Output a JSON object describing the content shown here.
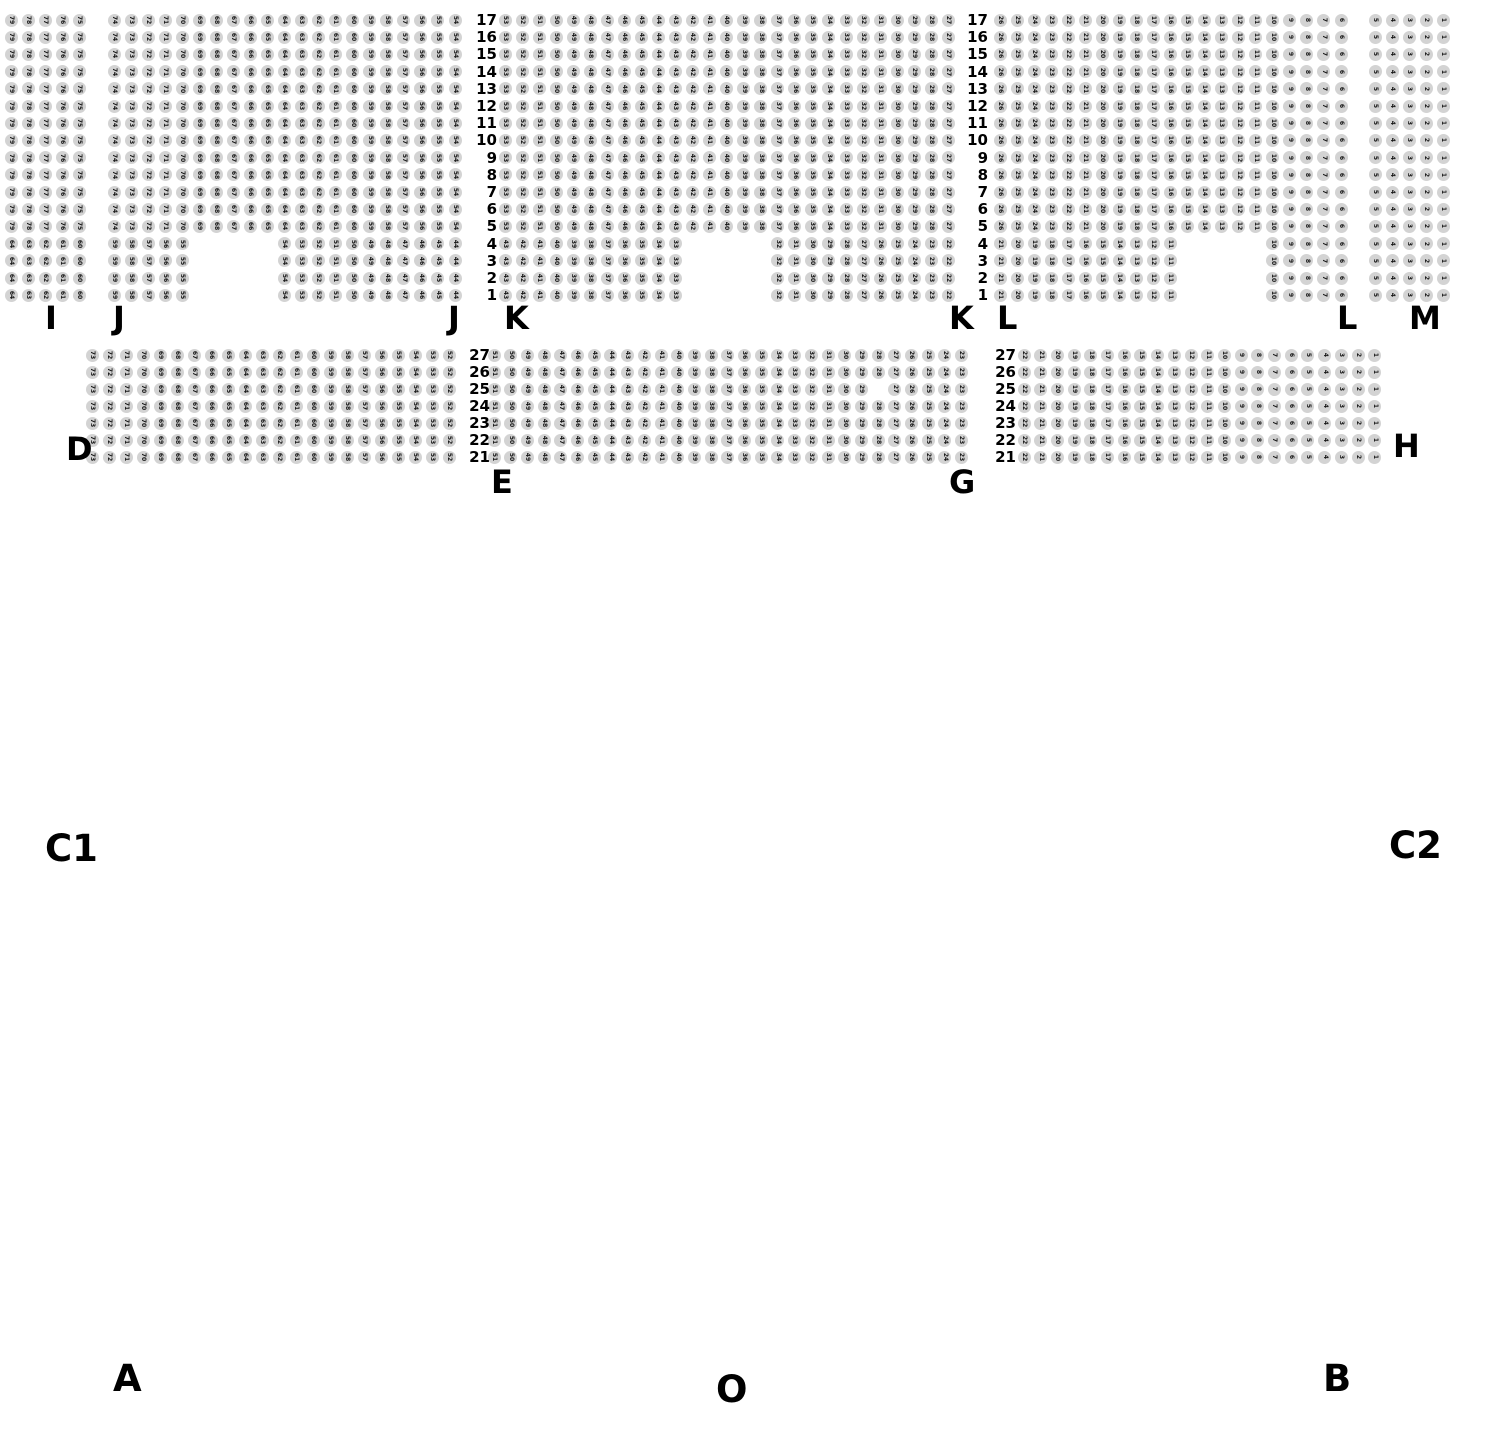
{
  "canvas": {
    "width": 1490,
    "height": 1430,
    "background": "#ffffff"
  },
  "seat_style": {
    "fill": "#d3d3d3",
    "number_color": "#151515",
    "diameter": 13
  },
  "top_block": {
    "y_first_row": 20,
    "row_step": 17.2,
    "rows_from": 17,
    "rows_to": 1,
    "full_rows_until": 5,
    "row_label_cols_x": [
      497,
      988
    ],
    "sections": [
      {
        "name": "I",
        "x0": 11,
        "dx": 17.05,
        "cols": 5,
        "first_seat": 79,
        "short_blocks": [
          {
            "start_col": 1,
            "count": 5,
            "first_seat": 64
          }
        ]
      },
      {
        "name": "J",
        "x0": 114,
        "dx": 17.05,
        "cols": 21,
        "first_seat": 74,
        "short_blocks": [
          {
            "start_col": 1,
            "count": 5,
            "first_seat": 59
          },
          {
            "start_col": 11,
            "count": 11,
            "first_seat": 54
          }
        ]
      },
      {
        "name": "K",
        "x0": 505,
        "dx": 17.05,
        "cols": 27,
        "first_seat": 53,
        "short_blocks": [
          {
            "start_col": 1,
            "count": 11,
            "first_seat": 43
          },
          {
            "start_col": 17,
            "count": 11,
            "first_seat": 32
          }
        ]
      },
      {
        "name": "L",
        "x0": 1000,
        "dx": 17.05,
        "cols": 21,
        "first_seat": 26,
        "short_blocks": [
          {
            "start_col": 1,
            "count": 11,
            "first_seat": 21
          },
          {
            "start_col": 17,
            "count": 5,
            "first_seat": 10
          }
        ]
      },
      {
        "name": "M",
        "x0": 1375,
        "dx": 17.05,
        "cols": 5,
        "first_seat": 5,
        "short_blocks": [
          {
            "start_col": 1,
            "count": 5,
            "first_seat": 5
          }
        ]
      }
    ]
  },
  "middle_block": {
    "y_first_row": 355,
    "row_step": 17,
    "rows_from": 27,
    "rows_to": 21,
    "row_label_cols_x": [
      490,
      1016
    ],
    "sections": [
      {
        "name": "D",
        "x0": 92,
        "dx": 17.0,
        "cols": 22,
        "first_seat": 73,
        "missing": []
      },
      {
        "name": "E-G",
        "x0": 494,
        "dx": 16.7,
        "cols": 29,
        "first_seat": 51,
        "missing": [
          {
            "row": 25,
            "seat": 28
          }
        ]
      },
      {
        "name": "H",
        "x0": 1024,
        "dx": 16.7,
        "cols": 22,
        "first_seat": 22,
        "missing": []
      }
    ]
  },
  "section_labels": [
    {
      "text": "I",
      "x": 45,
      "y": 302,
      "kind": "sec"
    },
    {
      "text": "J",
      "x": 113,
      "y": 302,
      "kind": "sec"
    },
    {
      "text": "J",
      "x": 448,
      "y": 302,
      "kind": "sec"
    },
    {
      "text": "K",
      "x": 504,
      "y": 302,
      "kind": "sec"
    },
    {
      "text": "K",
      "x": 949,
      "y": 302,
      "kind": "sec"
    },
    {
      "text": "L",
      "x": 997,
      "y": 302,
      "kind": "sec"
    },
    {
      "text": "L",
      "x": 1337,
      "y": 302,
      "kind": "sec"
    },
    {
      "text": "M",
      "x": 1409,
      "y": 302,
      "kind": "sec"
    },
    {
      "text": "D",
      "x": 66,
      "y": 433,
      "kind": "sec"
    },
    {
      "text": "E",
      "x": 491,
      "y": 466,
      "kind": "sec"
    },
    {
      "text": "G",
      "x": 949,
      "y": 466,
      "kind": "sec"
    },
    {
      "text": "H",
      "x": 1393,
      "y": 430,
      "kind": "sec"
    },
    {
      "text": "C1",
      "x": 45,
      "y": 830,
      "kind": "zone"
    },
    {
      "text": "C2",
      "x": 1389,
      "y": 827,
      "kind": "zone"
    },
    {
      "text": "A",
      "x": 113,
      "y": 1360,
      "kind": "zone"
    },
    {
      "text": "O",
      "x": 716,
      "y": 1371,
      "kind": "zone"
    },
    {
      "text": "B",
      "x": 1323,
      "y": 1360,
      "kind": "zone"
    }
  ]
}
